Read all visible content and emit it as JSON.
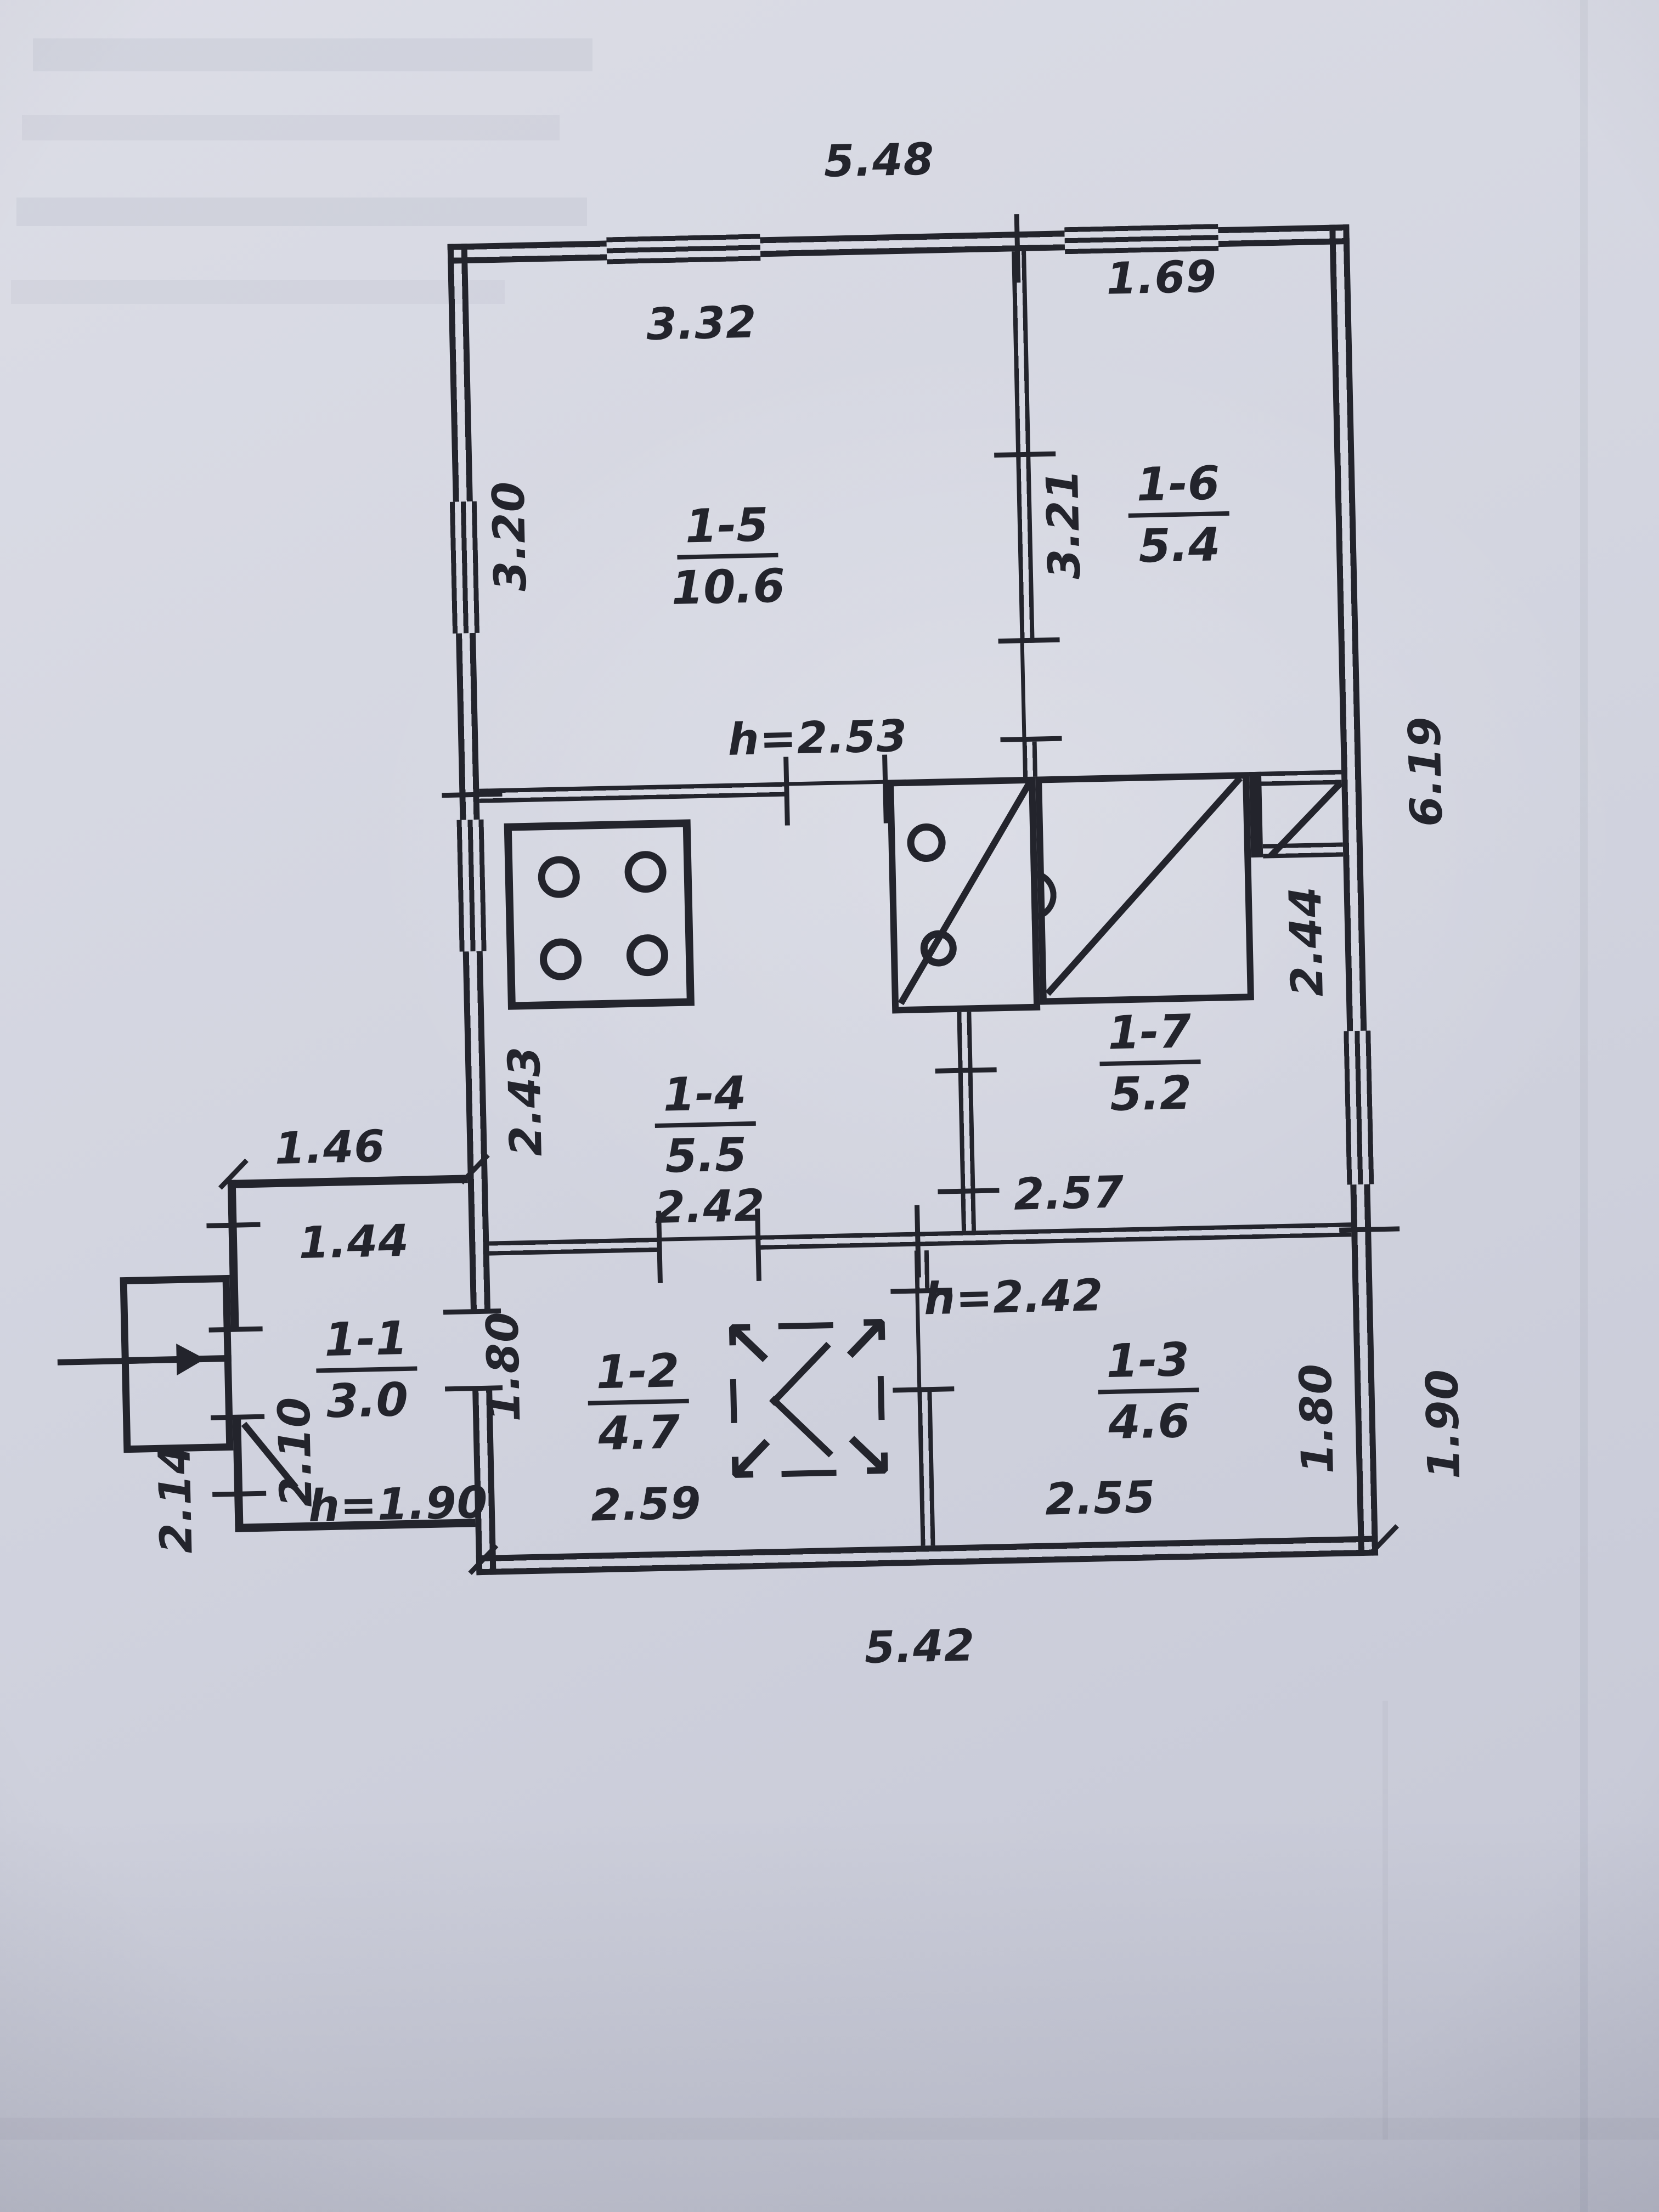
{
  "photo": {
    "paper_color": "#d3d5e0",
    "ink_color": "#23242c"
  },
  "plan": {
    "dims": {
      "top_width": "5.48",
      "bottom_width": "5.42",
      "right_upper": "6.19",
      "right_lower": "1.90",
      "hall_height_note": "h=2.53",
      "lower_hall_height_note": "h=2.42",
      "r15_width": "3.32",
      "r15_height": "3.20",
      "r16_width": "1.69",
      "r16_height": "3.21",
      "r14_height": "2.43",
      "r14_width": "2.42",
      "r17_height": "2.44",
      "r17_width": "2.57",
      "annex_width_outer": "1.46",
      "annex_width_inner": "1.44",
      "annex_height_inner": "2.10",
      "annex_height_outer": "2.14",
      "annex_height_note": "h=1.90",
      "r12_height": "1.80",
      "r12_width": "2.59",
      "r13_width": "2.55",
      "r13_height": "1.80"
    },
    "rooms": [
      {
        "id": "1-5",
        "area": "10.6"
      },
      {
        "id": "1-6",
        "area": "5.4"
      },
      {
        "id": "1-4",
        "area": "5.5"
      },
      {
        "id": "1-7",
        "area": "5.2"
      },
      {
        "id": "1-1",
        "area": "3.0"
      },
      {
        "id": "1-2",
        "area": "4.7"
      },
      {
        "id": "1-3",
        "area": "4.6"
      }
    ],
    "hatch": {
      "arrows": [
        "↖",
        "↗",
        "↙",
        "↘"
      ]
    },
    "icons": {
      "stove": "stove-burners-icon",
      "furnace": "heating-furnace-icon",
      "attic_hatch": "attic-hatch-icon",
      "entrance_arrow": "entrance-arrow-icon"
    }
  }
}
